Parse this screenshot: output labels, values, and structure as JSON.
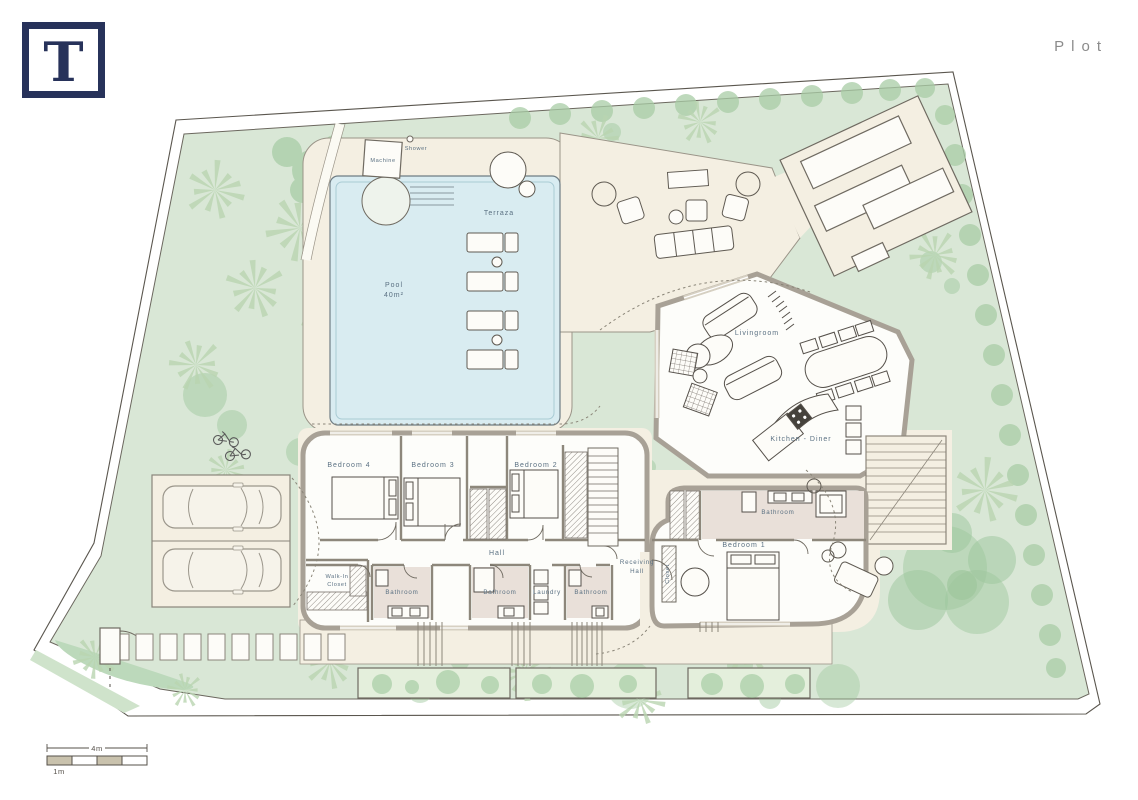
{
  "header": {
    "logo_letter": "T",
    "title": "Plot"
  },
  "plan": {
    "outdoor": {
      "pool": "Pool",
      "pool_area": "40m²",
      "terraza": "Terraza",
      "machine": "Machine",
      "shower": "Shower"
    },
    "rooms": {
      "livingroom": "Livingroom",
      "kitchen_diner": "Kitchen - Diner",
      "bedroom_4": "Bedroom 4",
      "bedroom_3": "Bedroom 3",
      "bedroom_2": "Bedroom 2",
      "bedroom_1": "Bedroom 1",
      "hall": "Hall",
      "receiving_hall_line1": "Receiving",
      "receiving_hall_line2": "Hall",
      "closet": "Closet",
      "walk_in_closet_line1": "Walk-In",
      "walk_in_closet_line2": "Closet",
      "bathroom_1": "Bathroom",
      "bathroom_2": "Bathroom",
      "laundry": "Laundry",
      "bathroom_3": "Bathroom",
      "bathroom_suite": "Bathroom"
    },
    "scale_bar": {
      "major": "4m",
      "minor": "1m"
    },
    "colors": {
      "grass": "#d9e7d6",
      "bush": "#a9cda6",
      "hardscape": "#f4efe2",
      "wall": "#a8a196",
      "pool_water": "#d9ecf1",
      "bathroom_floor": "#e9e0d9",
      "label_text": "#5a7082",
      "logo_navy": "#27325a",
      "title_gray": "#8b8b8b"
    }
  }
}
